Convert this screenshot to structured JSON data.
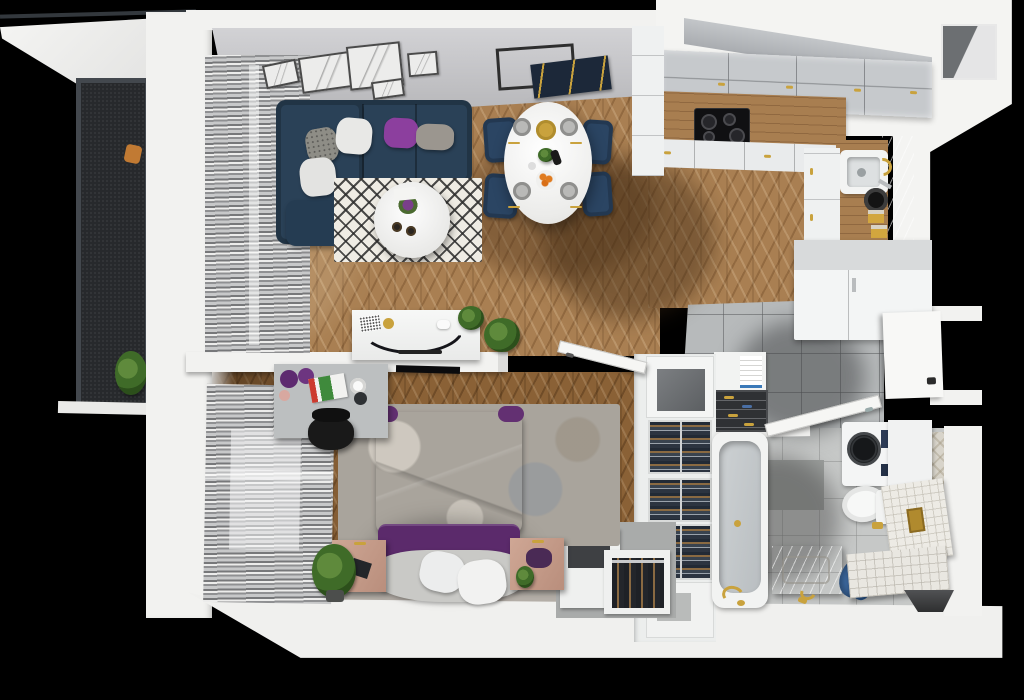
{
  "scene": {
    "title": "3D top-view floor plan of a studio apartment",
    "view": "top-down axonometric render",
    "background_color": "#000000",
    "palette": {
      "wall_white": "#f2f2f0",
      "wall_face_gray": "#c2c2c6",
      "wood_floor": "#a97f52",
      "wood_floor_dark": "#8a6136",
      "hall_tile": "#b7babb",
      "bath_tile": "#c6c8c7",
      "sofa_navy": "#2a4157",
      "chair_navy": "#2b4563",
      "bed_purple": "#5e2a70",
      "accent_purple": "#8c3f9e",
      "gold_accent": "#c9a23d",
      "rug_cream": "#efece4",
      "balcony_floor": "#27292c",
      "marble": "#dcd9d3"
    },
    "rooms": [
      {
        "name": "balcony",
        "floor": "dark perforated panels with dark frame",
        "items": [
          "orange lounge cushion",
          "potted plant"
        ]
      },
      {
        "name": "living-room",
        "floor": "herringbone oak",
        "items": [
          "navy L-shaped sectional sofa",
          "gray patterned pillow",
          "white pillow",
          "purple pillow",
          "gray pillow",
          "white pillow",
          "black-white diamond rug",
          "round white coffee table with purple flowers and two candles",
          "five sketch wall frames",
          "window with gray blinds",
          "white media sideboard with TV, gold disc, QR card and plant",
          "floor plant"
        ]
      },
      {
        "name": "dining-area",
        "floor": "herringbone oak",
        "items": [
          "white oval dining table",
          "four navy chairs with gold legs",
          "four gray place settings with gold cutlery",
          "gold charger plate",
          "fruit bowl with oranges",
          "centerpiece plant",
          "thin black empty frame",
          "navy abstract frame with gold lines"
        ]
      },
      {
        "name": "kitchen",
        "floor": "herringbone oak",
        "items": [
          "gray upper cabinet run with gold handles",
          "wood countertop",
          "black induction cooktop with four burners",
          "extractor grille",
          "white base cabinets",
          "granite sink with gold faucet",
          "marble backsplash",
          "black pot",
          "three gold storage jars",
          "tall white fridge cabinet"
        ]
      },
      {
        "name": "hallway",
        "floor": "gray ceramic tiles",
        "items": [
          "open white shelf with linens",
          "dark shoe rack with shoes",
          "open bedroom door",
          "open bathroom door",
          "open entry door with dark handle",
          "wall niche (top-right shaft)"
        ]
      },
      {
        "name": "wardrobe-column",
        "floor": "concrete gray",
        "items": [
          "mirror-top cabinet",
          "three open wardrobe sections with hanging clothes on rails",
          "lower cabinet",
          "shoe cabinet with vertical shoe slots"
        ]
      },
      {
        "name": "bedroom",
        "floor": "dark herringbone oak with pale rug strip",
        "items": [
          "double bed with purple duvet",
          "white and gray pillows",
          "mottled gray rug",
          "two light-wood nightstands",
          "black book",
          "dark purple cushion",
          "small plant",
          "gray desk with two purple poufs, magazines, plate and lamp",
          "black office chair",
          "wall-mounted TV",
          "floor plant",
          "window with gray blinds"
        ]
      },
      {
        "name": "bathroom",
        "floor": "light gray tiles with herringbone strip",
        "items": [
          "bathtub with gold floor faucet",
          "washing machine with dark drum",
          "white side cabinet",
          "wall-hung toilet with gold flush",
          "white tiled half wall with gold plate",
          "marble vanity with gold tap",
          "blue towel on floor",
          "tiled bench",
          "dark floor niche"
        ]
      }
    ]
  }
}
